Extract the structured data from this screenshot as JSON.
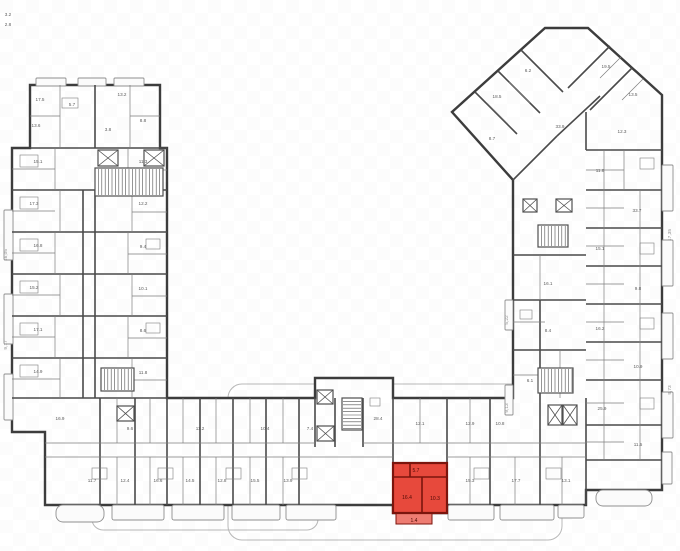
{
  "colors": {
    "background": "#ffffff",
    "outline_wall": "#3d3d3d",
    "unit_wall": "#4a4a4a",
    "partition": "#7e7e7e",
    "core": "#4f4f4f",
    "balcony_stroke": "#8f8f8f",
    "balcony_fill": "#fbfbfb",
    "terrace_stroke": "#b9b9b9",
    "label": "#5c5c5c",
    "dim": "#909090",
    "watermark": "#000000",
    "highlight_fill": "#e7493c",
    "highlight_wall": "#7b150d",
    "highlight_balcony": "#ee7c72",
    "highlight_label": "#4d0a05"
  },
  "canvas": {
    "width": 680,
    "height": 551
  },
  "outline": [
    [
      30,
      85
    ],
    [
      160,
      85
    ],
    [
      160,
      148
    ],
    [
      167,
      148
    ],
    [
      167,
      398
    ],
    [
      315,
      398
    ],
    [
      315,
      378
    ],
    [
      393,
      378
    ],
    [
      393,
      398
    ],
    [
      513,
      398
    ],
    [
      513,
      180
    ],
    [
      452,
      112
    ],
    [
      545,
      28
    ],
    [
      588,
      28
    ],
    [
      662,
      95
    ],
    [
      662,
      490
    ],
    [
      586,
      490
    ],
    [
      586,
      505
    ],
    [
      447,
      505
    ],
    [
      447,
      513
    ],
    [
      393,
      513
    ],
    [
      393,
      505
    ],
    [
      45,
      505
    ],
    [
      45,
      432
    ],
    [
      12,
      432
    ],
    [
      12,
      148
    ],
    [
      30,
      148
    ]
  ],
  "terraces": [
    {
      "x": 92,
      "y": 500,
      "w": 226,
      "h": 30,
      "r": 11
    },
    {
      "x": 228,
      "y": 384,
      "w": 334,
      "h": 156,
      "r": 14
    }
  ],
  "balconies": [
    {
      "x": 36,
      "y": 78,
      "w": 30,
      "h": 8,
      "r": 1
    },
    {
      "x": 78,
      "y": 78,
      "w": 28,
      "h": 8,
      "r": 1
    },
    {
      "x": 114,
      "y": 78,
      "w": 30,
      "h": 8,
      "r": 1
    },
    {
      "x": 4,
      "y": 210,
      "w": 9,
      "h": 50,
      "r": 1
    },
    {
      "x": 4,
      "y": 294,
      "w": 9,
      "h": 50,
      "r": 1
    },
    {
      "x": 4,
      "y": 374,
      "w": 9,
      "h": 46,
      "r": 1
    },
    {
      "x": 56,
      "y": 505,
      "w": 48,
      "h": 17,
      "r": 7
    },
    {
      "x": 112,
      "y": 505,
      "w": 52,
      "h": 15,
      "r": 2
    },
    {
      "x": 172,
      "y": 505,
      "w": 52,
      "h": 15,
      "r": 2
    },
    {
      "x": 232,
      "y": 505,
      "w": 48,
      "h": 15,
      "r": 2
    },
    {
      "x": 286,
      "y": 505,
      "w": 50,
      "h": 15,
      "r": 2
    },
    {
      "x": 448,
      "y": 505,
      "w": 46,
      "h": 15,
      "r": 2
    },
    {
      "x": 500,
      "y": 505,
      "w": 54,
      "h": 15,
      "r": 2
    },
    {
      "x": 558,
      "y": 505,
      "w": 26,
      "h": 13,
      "r": 2
    },
    {
      "x": 596,
      "y": 490,
      "w": 56,
      "h": 16,
      "r": 7
    },
    {
      "x": 662,
      "y": 165,
      "w": 11,
      "h": 46,
      "r": 1
    },
    {
      "x": 662,
      "y": 240,
      "w": 11,
      "h": 46,
      "r": 1
    },
    {
      "x": 662,
      "y": 313,
      "w": 11,
      "h": 46,
      "r": 1
    },
    {
      "x": 662,
      "y": 392,
      "w": 11,
      "h": 46,
      "r": 1
    },
    {
      "x": 662,
      "y": 452,
      "w": 10,
      "h": 32,
      "r": 1
    },
    {
      "x": 505,
      "y": 300,
      "w": 8,
      "h": 30,
      "r": 1
    },
    {
      "x": 505,
      "y": 385,
      "w": 8,
      "h": 30,
      "r": 1
    }
  ],
  "unit_walls": [
    [
      12,
      190,
      167,
      190
    ],
    [
      12,
      232,
      167,
      232
    ],
    [
      12,
      274,
      167,
      274
    ],
    [
      12,
      316,
      167,
      316
    ],
    [
      12,
      358,
      167,
      358
    ],
    [
      12,
      398,
      167,
      398
    ],
    [
      30,
      148,
      167,
      148
    ],
    [
      95,
      85,
      95,
      148
    ],
    [
      83,
      190,
      83,
      398
    ],
    [
      95,
      190,
      95,
      398
    ],
    [
      100,
      398,
      100,
      505
    ],
    [
      135,
      398,
      135,
      505
    ],
    [
      167,
      398,
      167,
      505
    ],
    [
      200,
      398,
      200,
      505
    ],
    [
      233,
      398,
      233,
      505
    ],
    [
      266,
      398,
      266,
      505
    ],
    [
      299,
      398,
      299,
      505
    ],
    [
      315,
      398,
      315,
      447
    ],
    [
      335,
      398,
      335,
      447
    ],
    [
      363,
      398,
      363,
      447
    ],
    [
      393,
      398,
      393,
      463
    ],
    [
      447,
      398,
      447,
      505
    ],
    [
      490,
      398,
      490,
      505
    ],
    [
      540,
      398,
      540,
      505
    ],
    [
      586,
      398,
      586,
      505
    ],
    [
      586,
      150,
      662,
      150
    ],
    [
      586,
      190,
      662,
      190
    ],
    [
      586,
      228,
      662,
      228
    ],
    [
      586,
      266,
      662,
      266
    ],
    [
      586,
      304,
      662,
      304
    ],
    [
      586,
      342,
      662,
      342
    ],
    [
      586,
      380,
      662,
      380
    ],
    [
      586,
      425,
      662,
      425
    ],
    [
      586,
      460,
      662,
      460
    ],
    [
      586,
      112,
      586,
      150
    ],
    [
      475,
      92,
      517,
      134
    ],
    [
      498,
      71,
      540,
      113
    ],
    [
      521,
      50,
      563,
      92
    ],
    [
      610,
      46,
      568,
      88
    ],
    [
      632,
      68,
      590,
      110
    ],
    [
      513,
      180,
      557,
      136
    ],
    [
      557,
      136,
      600,
      96
    ],
    [
      513,
      255,
      586,
      255
    ],
    [
      513,
      300,
      586,
      300
    ],
    [
      513,
      350,
      586,
      350
    ],
    [
      540,
      300,
      540,
      398
    ]
  ],
  "partitions": [
    [
      12,
      169,
      55,
      169
    ],
    [
      55,
      148,
      55,
      190
    ],
    [
      128,
      148,
      128,
      190
    ],
    [
      128,
      170,
      167,
      170
    ],
    [
      12,
      211,
      55,
      211
    ],
    [
      60,
      190,
      60,
      232
    ],
    [
      132,
      190,
      132,
      232
    ],
    [
      132,
      212,
      167,
      212
    ],
    [
      55,
      232,
      55,
      274
    ],
    [
      12,
      253,
      55,
      253
    ],
    [
      128,
      232,
      128,
      274
    ],
    [
      128,
      254,
      167,
      254
    ],
    [
      60,
      274,
      60,
      316
    ],
    [
      12,
      295,
      60,
      295
    ],
    [
      132,
      274,
      132,
      316
    ],
    [
      132,
      296,
      167,
      296
    ],
    [
      55,
      316,
      55,
      358
    ],
    [
      12,
      337,
      55,
      337
    ],
    [
      128,
      316,
      128,
      358
    ],
    [
      128,
      338,
      167,
      338
    ],
    [
      60,
      358,
      60,
      398
    ],
    [
      12,
      379,
      60,
      379
    ],
    [
      132,
      358,
      132,
      398
    ],
    [
      132,
      380,
      167,
      380
    ],
    [
      60,
      85,
      60,
      148
    ],
    [
      130,
      85,
      130,
      148
    ],
    [
      30,
      116,
      60,
      116
    ],
    [
      130,
      116,
      160,
      116
    ],
    [
      45,
      443,
      315,
      443
    ],
    [
      363,
      443,
      586,
      443
    ],
    [
      45,
      457,
      393,
      457
    ],
    [
      447,
      457,
      586,
      457
    ],
    [
      117,
      457,
      117,
      505
    ],
    [
      150,
      457,
      150,
      505
    ],
    [
      183,
      457,
      183,
      505
    ],
    [
      216,
      457,
      216,
      505
    ],
    [
      250,
      457,
      250,
      505
    ],
    [
      283,
      457,
      283,
      505
    ],
    [
      470,
      457,
      470,
      505
    ],
    [
      515,
      457,
      515,
      505
    ],
    [
      562,
      457,
      562,
      505
    ],
    [
      117,
      398,
      117,
      443
    ],
    [
      150,
      398,
      150,
      443
    ],
    [
      183,
      398,
      183,
      443
    ],
    [
      216,
      398,
      216,
      443
    ],
    [
      250,
      398,
      250,
      443
    ],
    [
      283,
      398,
      283,
      443
    ],
    [
      420,
      398,
      420,
      443
    ],
    [
      470,
      398,
      470,
      443
    ],
    [
      624,
      150,
      624,
      190
    ],
    [
      586,
      170,
      624,
      170
    ],
    [
      640,
      190,
      640,
      228
    ],
    [
      586,
      208,
      624,
      208
    ],
    [
      640,
      228,
      640,
      266
    ],
    [
      586,
      246,
      624,
      246
    ],
    [
      640,
      266,
      640,
      304
    ],
    [
      586,
      284,
      624,
      284
    ],
    [
      640,
      304,
      640,
      342
    ],
    [
      586,
      322,
      624,
      322
    ],
    [
      640,
      342,
      640,
      380
    ],
    [
      586,
      360,
      624,
      360
    ],
    [
      640,
      380,
      640,
      425
    ],
    [
      586,
      403,
      624,
      403
    ],
    [
      640,
      425,
      640,
      460
    ],
    [
      586,
      442,
      624,
      442
    ],
    [
      604,
      150,
      604,
      460
    ],
    [
      487,
      103,
      508,
      124
    ],
    [
      509,
      82,
      530,
      103
    ],
    [
      621,
      57,
      600,
      78
    ],
    [
      643,
      79,
      622,
      100
    ],
    [
      540,
      255,
      540,
      300
    ],
    [
      513,
      322,
      545,
      322
    ],
    [
      560,
      350,
      560,
      398
    ],
    [
      513,
      375,
      560,
      375
    ]
  ],
  "furniture": [
    {
      "x": 20,
      "y": 155,
      "w": 18,
      "h": 12
    },
    {
      "x": 20,
      "y": 197,
      "w": 18,
      "h": 12
    },
    {
      "x": 20,
      "y": 239,
      "w": 18,
      "h": 12
    },
    {
      "x": 20,
      "y": 281,
      "w": 18,
      "h": 12
    },
    {
      "x": 20,
      "y": 323,
      "w": 18,
      "h": 12
    },
    {
      "x": 20,
      "y": 365,
      "w": 18,
      "h": 12
    },
    {
      "x": 146,
      "y": 155,
      "w": 14,
      "h": 10
    },
    {
      "x": 146,
      "y": 239,
      "w": 14,
      "h": 10
    },
    {
      "x": 146,
      "y": 323,
      "w": 14,
      "h": 10
    },
    {
      "x": 92,
      "y": 468,
      "w": 15,
      "h": 11
    },
    {
      "x": 158,
      "y": 468,
      "w": 15,
      "h": 11
    },
    {
      "x": 226,
      "y": 468,
      "w": 15,
      "h": 11
    },
    {
      "x": 292,
      "y": 468,
      "w": 15,
      "h": 11
    },
    {
      "x": 474,
      "y": 468,
      "w": 15,
      "h": 11
    },
    {
      "x": 546,
      "y": 468,
      "w": 15,
      "h": 11
    },
    {
      "x": 640,
      "y": 158,
      "w": 14,
      "h": 11
    },
    {
      "x": 640,
      "y": 243,
      "w": 14,
      "h": 11
    },
    {
      "x": 640,
      "y": 318,
      "w": 14,
      "h": 11
    },
    {
      "x": 640,
      "y": 398,
      "w": 14,
      "h": 11
    },
    {
      "x": 62,
      "y": 98,
      "w": 16,
      "h": 10
    },
    {
      "x": 520,
      "y": 310,
      "w": 12,
      "h": 9
    },
    {
      "x": 545,
      "y": 370,
      "w": 12,
      "h": 9
    },
    {
      "x": 370,
      "y": 398,
      "w": 10,
      "h": 8
    }
  ],
  "elevators": [
    {
      "x": 98,
      "y": 150,
      "w": 20,
      "h": 16
    },
    {
      "x": 144,
      "y": 150,
      "w": 20,
      "h": 16
    },
    {
      "x": 317,
      "y": 390,
      "w": 16,
      "h": 14
    },
    {
      "x": 317,
      "y": 426,
      "w": 17,
      "h": 15
    },
    {
      "x": 548,
      "y": 405,
      "w": 14,
      "h": 20
    },
    {
      "x": 563,
      "y": 405,
      "w": 14,
      "h": 20
    },
    {
      "x": 523,
      "y": 199,
      "w": 14,
      "h": 13
    },
    {
      "x": 556,
      "y": 199,
      "w": 16,
      "h": 13
    },
    {
      "x": 117,
      "y": 406,
      "w": 17,
      "h": 15
    }
  ],
  "stairs": [
    {
      "x": 95,
      "y": 168,
      "w": 68,
      "h": 28,
      "dir": "v"
    },
    {
      "x": 342,
      "y": 398,
      "w": 20,
      "h": 32,
      "dir": "h"
    },
    {
      "x": 538,
      "y": 368,
      "w": 35,
      "h": 25,
      "dir": "v"
    },
    {
      "x": 101,
      "y": 368,
      "w": 33,
      "h": 23,
      "dir": "v"
    },
    {
      "x": 538,
      "y": 225,
      "w": 30,
      "h": 22,
      "dir": "v"
    }
  ],
  "highlight": {
    "name": "selected-apartment",
    "outline": [
      [
        393,
        463
      ],
      [
        447,
        463
      ],
      [
        447,
        513
      ],
      [
        393,
        513
      ]
    ],
    "walls": [
      [
        393,
        477,
        447,
        477
      ],
      [
        422,
        477,
        422,
        513
      ],
      [
        410,
        463,
        410,
        477
      ]
    ],
    "balcony": {
      "x": 396,
      "y": 513,
      "w": 36,
      "h": 11
    },
    "labels": [
      {
        "x": 416,
        "y": 472,
        "t": "5.7"
      },
      {
        "x": 407,
        "y": 499,
        "t": "16.4"
      },
      {
        "x": 435,
        "y": 500,
        "t": "10.3"
      },
      {
        "x": 414,
        "y": 522,
        "t": "1.4"
      }
    ]
  },
  "labels": [
    {
      "x": 40,
      "y": 101,
      "t": "17.5"
    },
    {
      "x": 122,
      "y": 96,
      "t": "13.2"
    },
    {
      "x": 72,
      "y": 106,
      "t": "5.7"
    },
    {
      "x": 108,
      "y": 131,
      "t": "3.8"
    },
    {
      "x": 36,
      "y": 127,
      "t": "13.6"
    },
    {
      "x": 143,
      "y": 122,
      "t": "8.8"
    },
    {
      "x": 38,
      "y": 163,
      "t": "15.1"
    },
    {
      "x": 143,
      "y": 163,
      "t": "11.3"
    },
    {
      "x": 34,
      "y": 205,
      "t": "17.3"
    },
    {
      "x": 143,
      "y": 205,
      "t": "12.2"
    },
    {
      "x": 38,
      "y": 247,
      "t": "16.8"
    },
    {
      "x": 143,
      "y": 248,
      "t": "9.4"
    },
    {
      "x": 34,
      "y": 289,
      "t": "15.2"
    },
    {
      "x": 143,
      "y": 290,
      "t": "10.1"
    },
    {
      "x": 38,
      "y": 331,
      "t": "17.1"
    },
    {
      "x": 143,
      "y": 332,
      "t": "8.6"
    },
    {
      "x": 38,
      "y": 373,
      "t": "14.9"
    },
    {
      "x": 143,
      "y": 374,
      "t": "11.8"
    },
    {
      "x": 60,
      "y": 420,
      "t": "16.9"
    },
    {
      "x": 92,
      "y": 482,
      "t": "11.7"
    },
    {
      "x": 125,
      "y": 482,
      "t": "12.4"
    },
    {
      "x": 158,
      "y": 482,
      "t": "16.6"
    },
    {
      "x": 190,
      "y": 482,
      "t": "14.5"
    },
    {
      "x": 222,
      "y": 482,
      "t": "12.8"
    },
    {
      "x": 255,
      "y": 482,
      "t": "15.5"
    },
    {
      "x": 288,
      "y": 482,
      "t": "13.9"
    },
    {
      "x": 130,
      "y": 430,
      "t": "9.6"
    },
    {
      "x": 200,
      "y": 430,
      "t": "11.2"
    },
    {
      "x": 265,
      "y": 430,
      "t": "10.4"
    },
    {
      "x": 310,
      "y": 430,
      "t": "7.4"
    },
    {
      "x": 378,
      "y": 420,
      "t": "28.4"
    },
    {
      "x": 420,
      "y": 425,
      "t": "12.1"
    },
    {
      "x": 470,
      "y": 482,
      "t": "15.3"
    },
    {
      "x": 516,
      "y": 482,
      "t": "17.7"
    },
    {
      "x": 566,
      "y": 482,
      "t": "13.1"
    },
    {
      "x": 470,
      "y": 425,
      "t": "12.9"
    },
    {
      "x": 500,
      "y": 425,
      "t": "10.8"
    },
    {
      "x": 622,
      "y": 133,
      "t": "12.3"
    },
    {
      "x": 600,
      "y": 172,
      "t": "11.8"
    },
    {
      "x": 637,
      "y": 212,
      "t": "33.7"
    },
    {
      "x": 600,
      "y": 250,
      "t": "15.1"
    },
    {
      "x": 638,
      "y": 290,
      "t": "9.8"
    },
    {
      "x": 600,
      "y": 330,
      "t": "16.2"
    },
    {
      "x": 638,
      "y": 368,
      "t": "10.9"
    },
    {
      "x": 602,
      "y": 410,
      "t": "25.9"
    },
    {
      "x": 638,
      "y": 446,
      "t": "11.5"
    },
    {
      "x": 497,
      "y": 98,
      "t": "18.5"
    },
    {
      "x": 528,
      "y": 72,
      "t": "6.2"
    },
    {
      "x": 606,
      "y": 68,
      "t": "19.5"
    },
    {
      "x": 633,
      "y": 96,
      "t": "13.5"
    },
    {
      "x": 560,
      "y": 128,
      "t": "33.9"
    },
    {
      "x": 492,
      "y": 140,
      "t": "8.7"
    },
    {
      "x": 548,
      "y": 285,
      "t": "16.1"
    },
    {
      "x": 548,
      "y": 332,
      "t": "8.4"
    },
    {
      "x": 530,
      "y": 382,
      "t": "6.1"
    },
    {
      "x": 8,
      "y": 16,
      "t": "3.2"
    },
    {
      "x": 8,
      "y": 26,
      "t": "2.8"
    }
  ],
  "dims": [
    {
      "x": 7,
      "y": 255,
      "t": "16,05"
    },
    {
      "x": 7,
      "y": 345,
      "t": "9,17"
    },
    {
      "x": 671,
      "y": 235,
      "t": "17,35"
    },
    {
      "x": 671,
      "y": 390,
      "t": "9,73"
    },
    {
      "x": 508,
      "y": 320,
      "t": "5,22"
    },
    {
      "x": 508,
      "y": 408,
      "t": "9,13"
    }
  ]
}
